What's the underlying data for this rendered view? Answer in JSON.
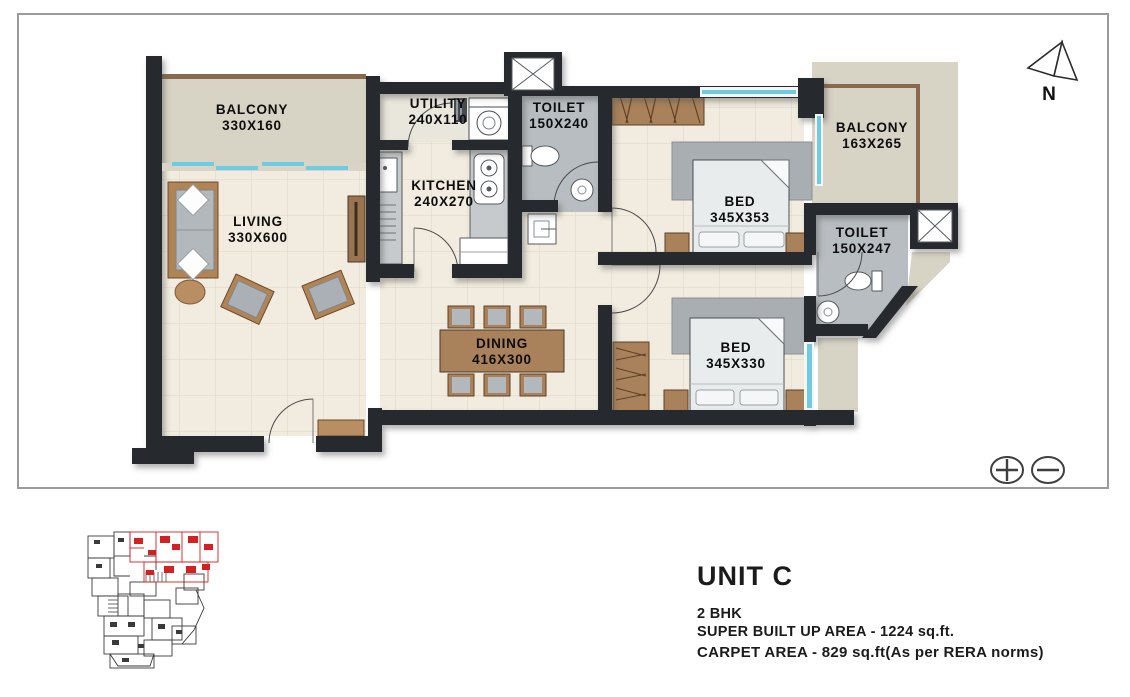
{
  "unit_info": {
    "title": "UNIT C",
    "type": "2 BHK",
    "super_built_up_area": "SUPER BUILT UP AREA - 1224 sq.ft.",
    "carpet_area": "CARPET AREA - 829 sq.ft(As per RERA norms)"
  },
  "compass": {
    "label": "N"
  },
  "rooms": {
    "balcony_left": {
      "name": "BALCONY",
      "dim": "330X160"
    },
    "utility": {
      "name": "UTILITY",
      "dim": "240X110"
    },
    "toilet_top": {
      "name": "TOILET",
      "dim": "150X240"
    },
    "balcony_right": {
      "name": "BALCONY",
      "dim": "163X265"
    },
    "living": {
      "name": "LIVING",
      "dim": "330X600"
    },
    "kitchen": {
      "name": "KITCHEN",
      "dim": "240X270"
    },
    "bed_master": {
      "name": "BED",
      "dim": "345X353"
    },
    "toilet_right": {
      "name": "TOILET",
      "dim": "150X247"
    },
    "dining": {
      "name": "DINING",
      "dim": "416X300"
    },
    "bed_second": {
      "name": "BED",
      "dim": "345X330"
    }
  },
  "controls": {
    "zoom_in_icon": "plus-circle",
    "zoom_out_icon": "minus-circle"
  },
  "key_plan": {
    "description": "floor-plate key plan with unit C highlighted",
    "highlight_color": "#d42020"
  },
  "colors": {
    "wall": "#26292e",
    "floor": "#f1ecdf",
    "balcony_floor": "#d7d3c5",
    "toilet_floor": "#b7bdc0",
    "wood": "#a9815a",
    "fabric": "#aab0b6",
    "window": "#6fcbe2",
    "railing": "#8a6a4f",
    "frame_border": "#9b9b9b"
  }
}
